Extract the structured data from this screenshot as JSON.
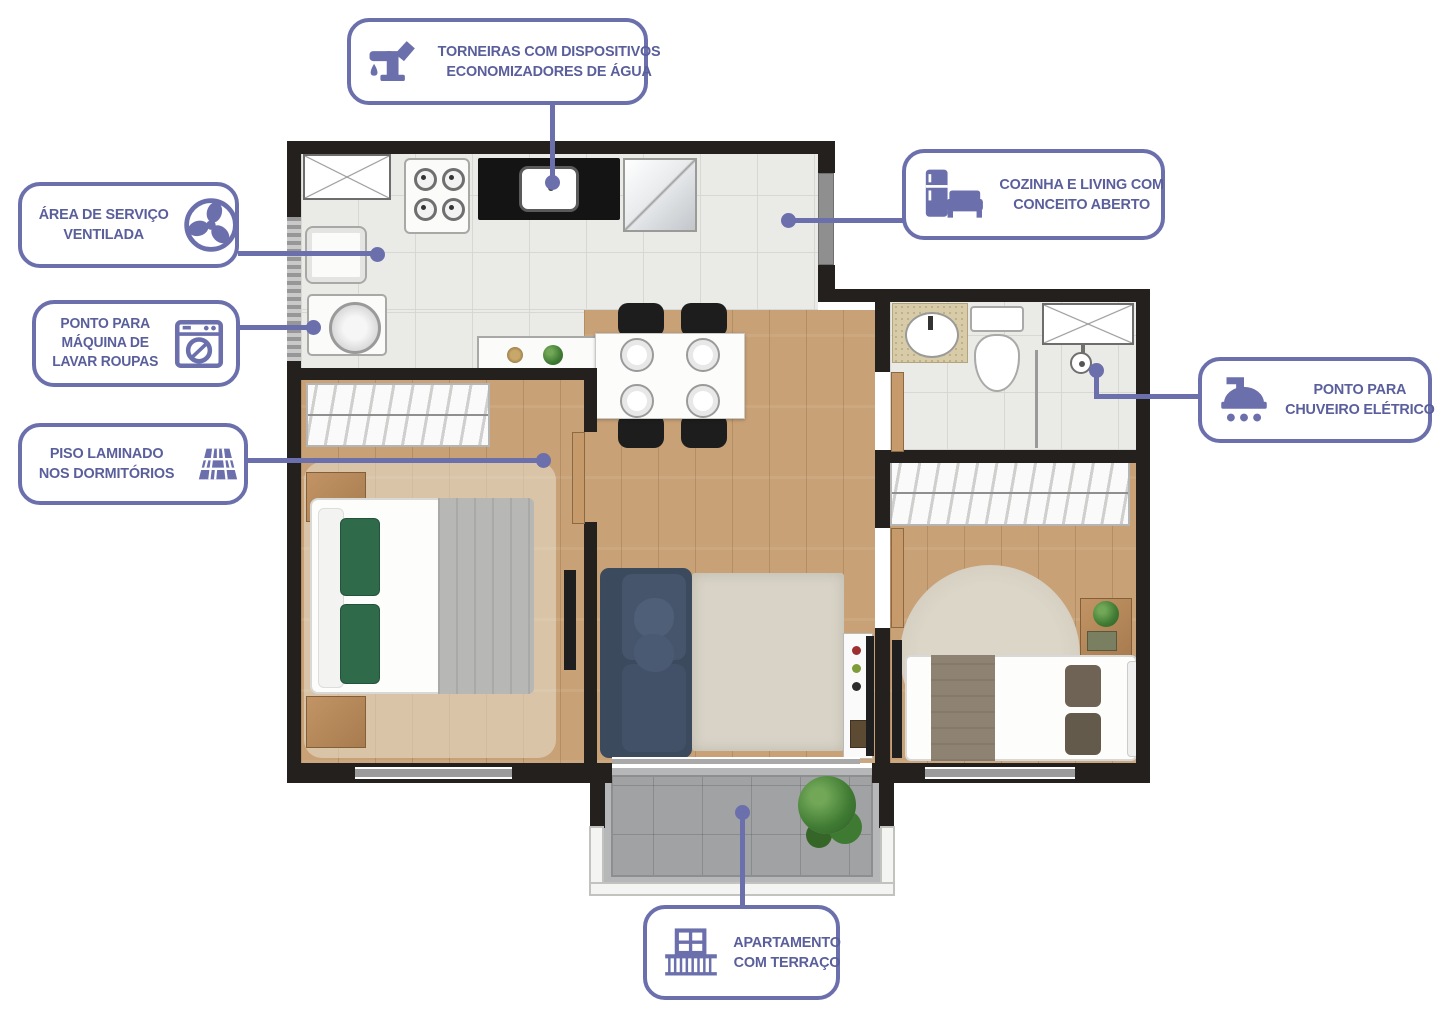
{
  "colors": {
    "accent": "#6B70AD",
    "callout_text": "#5A5F9C",
    "wall": "#23201E",
    "tile_floor": "#EAEAE7",
    "wood_floor": "#C8A176",
    "terrace_floor": "#A1A2A3",
    "sofa": "#3C4A5E",
    "rug": "#D8D3C6",
    "pillow_green": "#2F6B4B"
  },
  "callouts": [
    {
      "id": "torneiras-economizadores",
      "icon": "faucet-water-drop-icon",
      "lines": [
        "TORNEIRAS COM DISPOSITIVOS",
        "ECONOMIZADORES DE ÁGUA"
      ]
    },
    {
      "id": "area-servico-ventilada",
      "icon": "fan-icon",
      "lines": [
        "ÁREA DE SERVIÇO",
        "VENTILADA"
      ]
    },
    {
      "id": "ponto-maquina-lavar",
      "icon": "washing-machine-icon",
      "lines": [
        "PONTO PARA",
        "MÁQUINA DE",
        "LAVAR ROUPAS"
      ]
    },
    {
      "id": "piso-laminado-dormitorios",
      "icon": "laminate-floor-icon",
      "lines": [
        "PISO LAMINADO",
        "NOS DORMITÓRIOS"
      ]
    },
    {
      "id": "cozinha-living-conceito-aberto",
      "icon": "kitchen-living-icon",
      "lines": [
        "COZINHA E LIVING COM",
        "CONCEITO ABERTO"
      ]
    },
    {
      "id": "ponto-chuveiro-eletrico",
      "icon": "shower-icon",
      "lines": [
        "PONTO PARA",
        "CHUVEIRO ELÉTRICO"
      ]
    },
    {
      "id": "apartamento-terraco",
      "icon": "balcony-icon",
      "lines": [
        "APARTAMENTO",
        "COM TERRAÇO"
      ]
    }
  ]
}
